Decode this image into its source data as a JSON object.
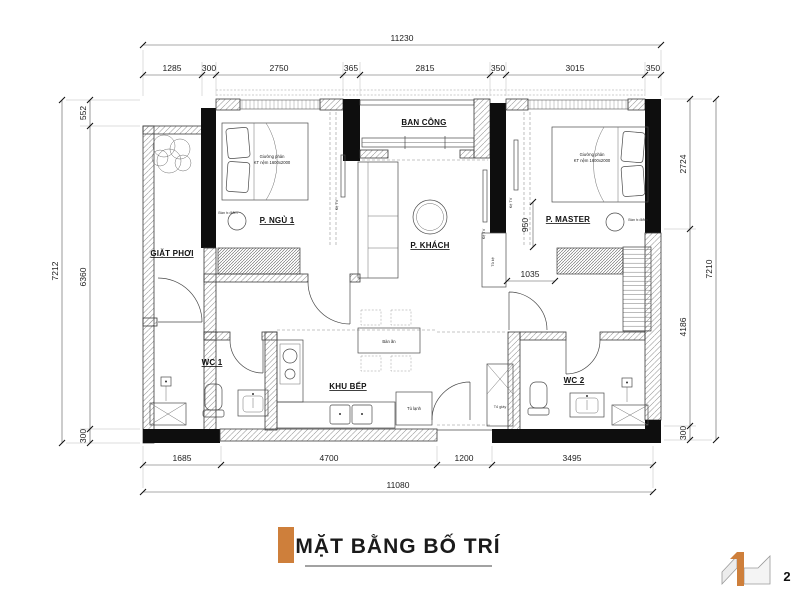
{
  "meta": {
    "page_number": "2",
    "colors": {
      "accent_orange": "#CE7F3B"
    }
  },
  "title_block": {
    "title": "MẶT BẰNG BỐ TRÍ"
  },
  "dimensions": {
    "top_total": "11230",
    "top_segments": [
      "1285",
      "300",
      "2750",
      "365",
      "2815",
      "350",
      "3015",
      "350"
    ],
    "left_outer": "7212",
    "left_segments": [
      "552",
      "6360",
      "300"
    ],
    "right_outer": "7210",
    "right_segments": [
      "2724",
      "4186",
      "300"
    ],
    "bottom_total": "11080",
    "bottom_segments": [
      "1685",
      "4700",
      "1200",
      "3495"
    ],
    "interior": {
      "master_depth": "950",
      "master_width": "1035"
    }
  },
  "rooms": {
    "laundry": "GIẶT PHƠI",
    "bedroom1": "P. NGỦ 1",
    "balcony": "BAN CÔNG",
    "living": "P. KHÁCH",
    "master": "P. MASTER",
    "wc1": "WC 1",
    "wc2": "WC 2",
    "kitchen": "KHU BẾP"
  },
  "furniture": {
    "bed_line1": "Giường phản",
    "bed_line2": "KT nệm 1600x2000",
    "tv_shelf": "Kệ TV",
    "dressing_table": "Bàn tr.điểm",
    "dining_table": "Bàn ăn",
    "fridge": "Tủ lạnh",
    "shoe_cabinet": "Tủ giày",
    "cabinet": "Tủ kệ"
  }
}
